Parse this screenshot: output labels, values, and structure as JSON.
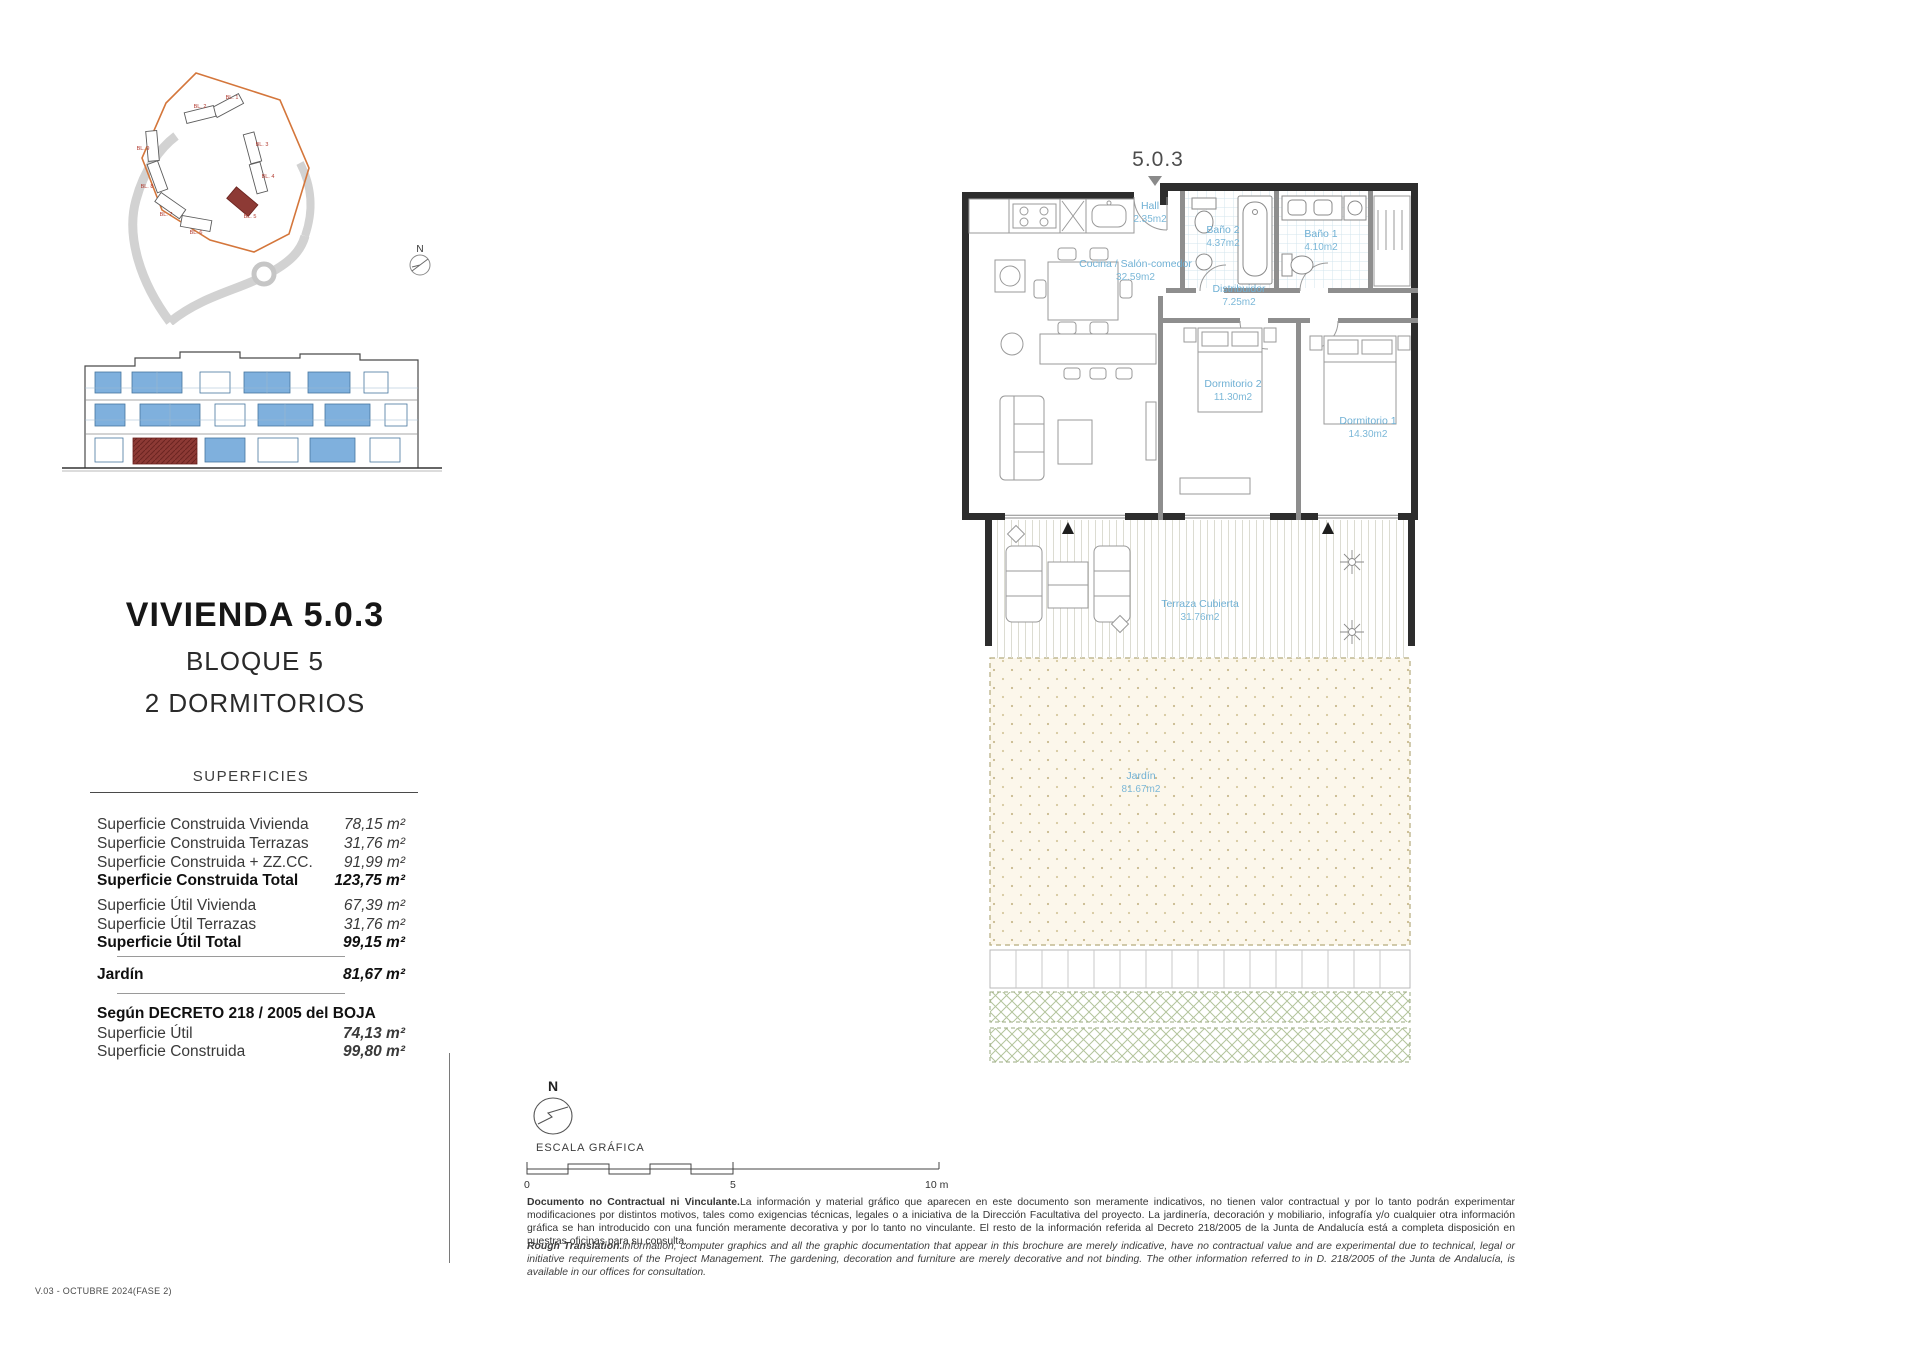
{
  "unit": {
    "title": "VIVIENDA 5.0.3",
    "subtitle_block": "BLOQUE 5",
    "subtitle_rooms": "2 DORMITORIOS",
    "plan_number": "5.0.3"
  },
  "surfaces": {
    "heading": "SUPERFICIES",
    "rows": [
      {
        "label": "Superficie Construida Vivienda",
        "value": "78,15 m²"
      },
      {
        "label": "Superficie Construida Terrazas",
        "value": "31,76 m²"
      },
      {
        "label": "Superficie Construida + ZZ.CC.",
        "value": "91,99 m²"
      },
      {
        "label": "Superficie Construida Total",
        "value": "123,75 m²"
      },
      {
        "label": "Superficie Útil Vivienda",
        "value": "67,39 m²"
      },
      {
        "label": "Superficie Útil Terrazas",
        "value": "31,76 m²"
      },
      {
        "label": "Superficie Útil Total",
        "value": "99,15 m²"
      }
    ],
    "jardin": {
      "label": "Jardín",
      "value": "81,67 m²"
    },
    "decreto": {
      "heading": "Según DECRETO 218 / 2005 del BOJA",
      "rows": [
        {
          "label": "Superficie Útil",
          "value": "74,13 m²"
        },
        {
          "label": "Superficie Construida",
          "value": "99,80 m²"
        }
      ]
    }
  },
  "floorplan": {
    "rooms": {
      "hall": {
        "name": "Hall",
        "area": "2.35m2"
      },
      "cocina": {
        "name": "Cocina / Salón-comedor",
        "area": "32.59m2"
      },
      "bano2": {
        "name": "Baño 2",
        "area": "4.37m2"
      },
      "bano1": {
        "name": "Baño 1",
        "area": "4.10m2"
      },
      "distribuidor": {
        "name": "Distribuidor",
        "area": "7.25m2"
      },
      "dormitorio2": {
        "name": "Dormitorio 2",
        "area": "11.30m2"
      },
      "dormitorio1": {
        "name": "Dormitorio 1",
        "area": "14.30m2"
      },
      "terraza": {
        "name": "Terraza Cubierta",
        "area": "31.76m2"
      },
      "jardin": {
        "name": "Jardín",
        "area": "81.67m2"
      }
    }
  },
  "site_plan": {
    "blocks": [
      "BL. 1",
      "BL. 2",
      "BL. 3",
      "BL. 4",
      "BL. 5",
      "BL. 6",
      "BL. 7",
      "BL. 8",
      "BL. 9"
    ]
  },
  "compass": {
    "n": "N"
  },
  "scale": {
    "label": "ESCALA GRÁFICA",
    "tick0": "0",
    "tick5": "5",
    "tick10": "10 m"
  },
  "disclaimer": {
    "es_lead": "Documento no Contractual ni Vinculante.",
    "es_body": "La información y material gráfico que aparecen en este documento son meramente indicativos, no tienen valor contractual y por lo tanto podrán experimentar modificaciones por distintos motivos, tales como exigencias técnicas, legales o a iniciativa de la Dirección Facultativa del proyecto. La jardinería, decoración y mobiliario, infografía y/o cualquier otra información gráfica se han introducido con una función meramente decorativa y por lo tanto no vinculante. El resto de la información referida al Decreto 218/2005 de la Junta de Andalucía está a completa disposición en nuestras oficinas para su consulta.",
    "en_lead": "Rough Translation.",
    "en_body": "information, computer graphics and all the graphic documentation that appear in this brochure are merely indicative, have no contractual value and are experimental due to technical, legal or initiative requirements of the Project Management. The gardening, decoration and furniture are merely decorative and not binding. The other information referred to in D. 218/2005 of the Junta de Andalucía, is available in our offices for consultation."
  },
  "footer": {
    "version": "V.03 - OCTUBRE 2024(FASE 2)"
  },
  "colors": {
    "accent_orange": "#d4763b",
    "highlight_red": "#8d3a35",
    "window_blue": "#7fb0dd",
    "label_blue": "#6fb0d4",
    "garden_cream": "#fcf7eb"
  }
}
